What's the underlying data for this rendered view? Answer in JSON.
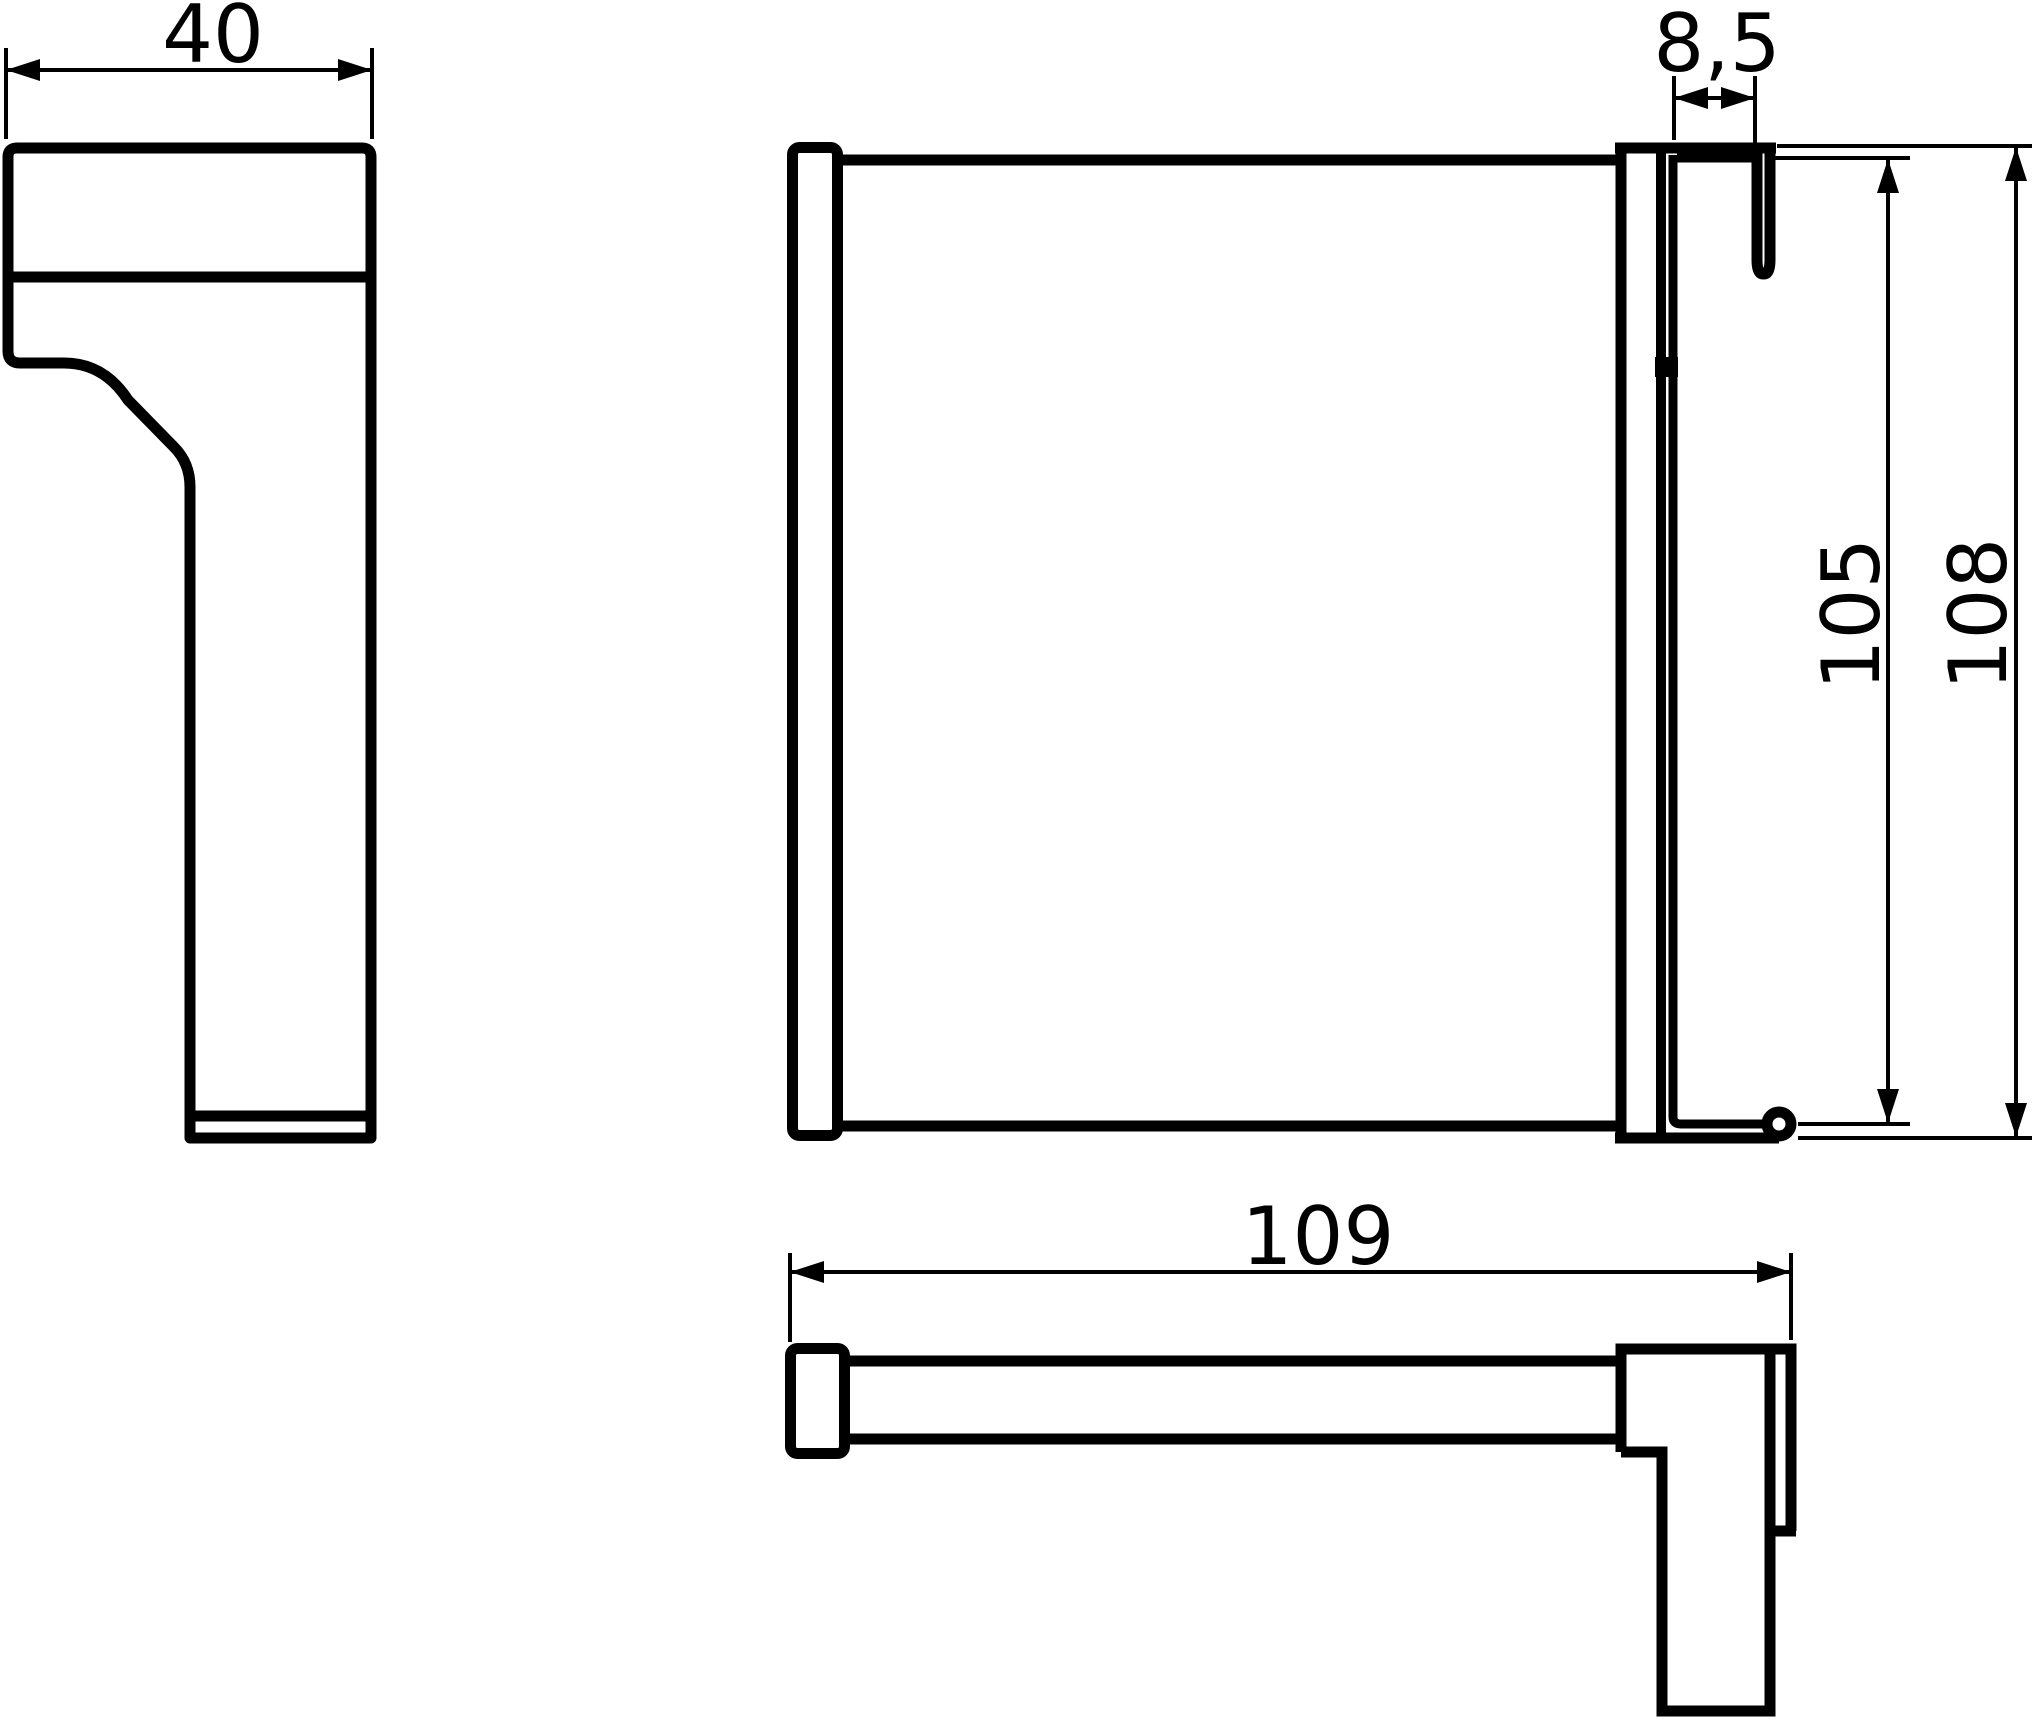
{
  "document": {
    "type": "technical-dimension-drawing",
    "background_color": "#ffffff",
    "line_color": "#000000",
    "views": [
      "side-view",
      "front-view",
      "bottom-view"
    ]
  },
  "dimensions": {
    "side_width": {
      "label": "40",
      "value": 40
    },
    "hook_gap": {
      "label": "8,5",
      "value": 8.5
    },
    "hook_inner_height": {
      "label": "105",
      "value": 105
    },
    "hook_outer_height": {
      "label": "108",
      "value": 108
    },
    "overall_length": {
      "label": "109",
      "value": 109
    }
  }
}
